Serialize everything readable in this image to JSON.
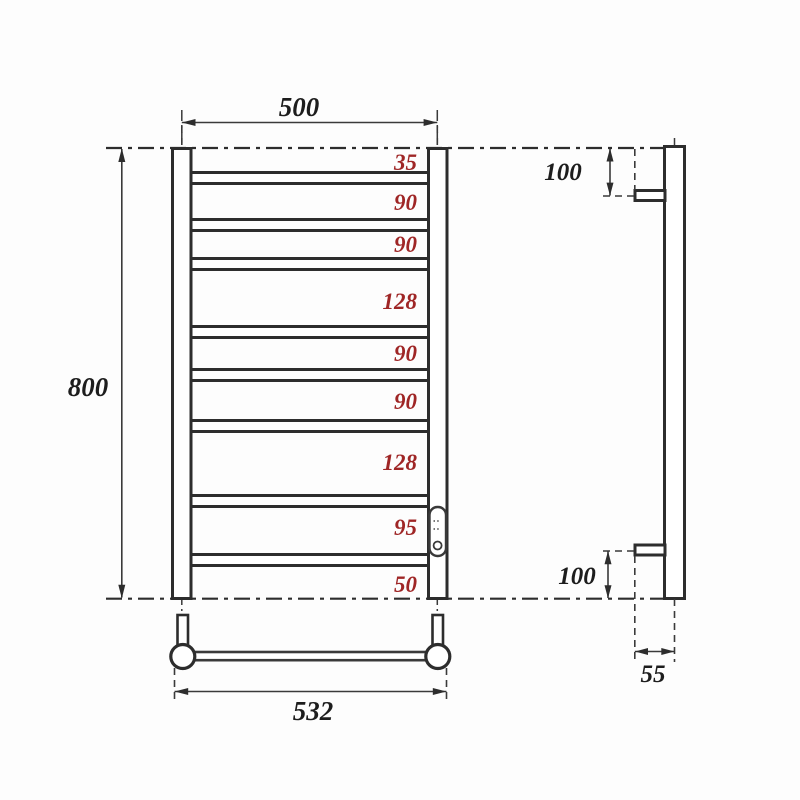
{
  "drawing": {
    "title": "heated-towel-rail-dimension-drawing",
    "front": {
      "overall_width": "500",
      "overall_height": "800",
      "mount_width": "532",
      "rung_gaps": [
        "35",
        "90",
        "90",
        "128",
        "90",
        "90",
        "128",
        "95",
        "50"
      ]
    },
    "side": {
      "top_bracket_offset": "100",
      "bottom_bracket_offset": "100",
      "bracket_depth": "55"
    },
    "colors": {
      "line": "#2d2d2d",
      "gap_label_red": "#9f2626",
      "background": "#ffffff"
    }
  }
}
